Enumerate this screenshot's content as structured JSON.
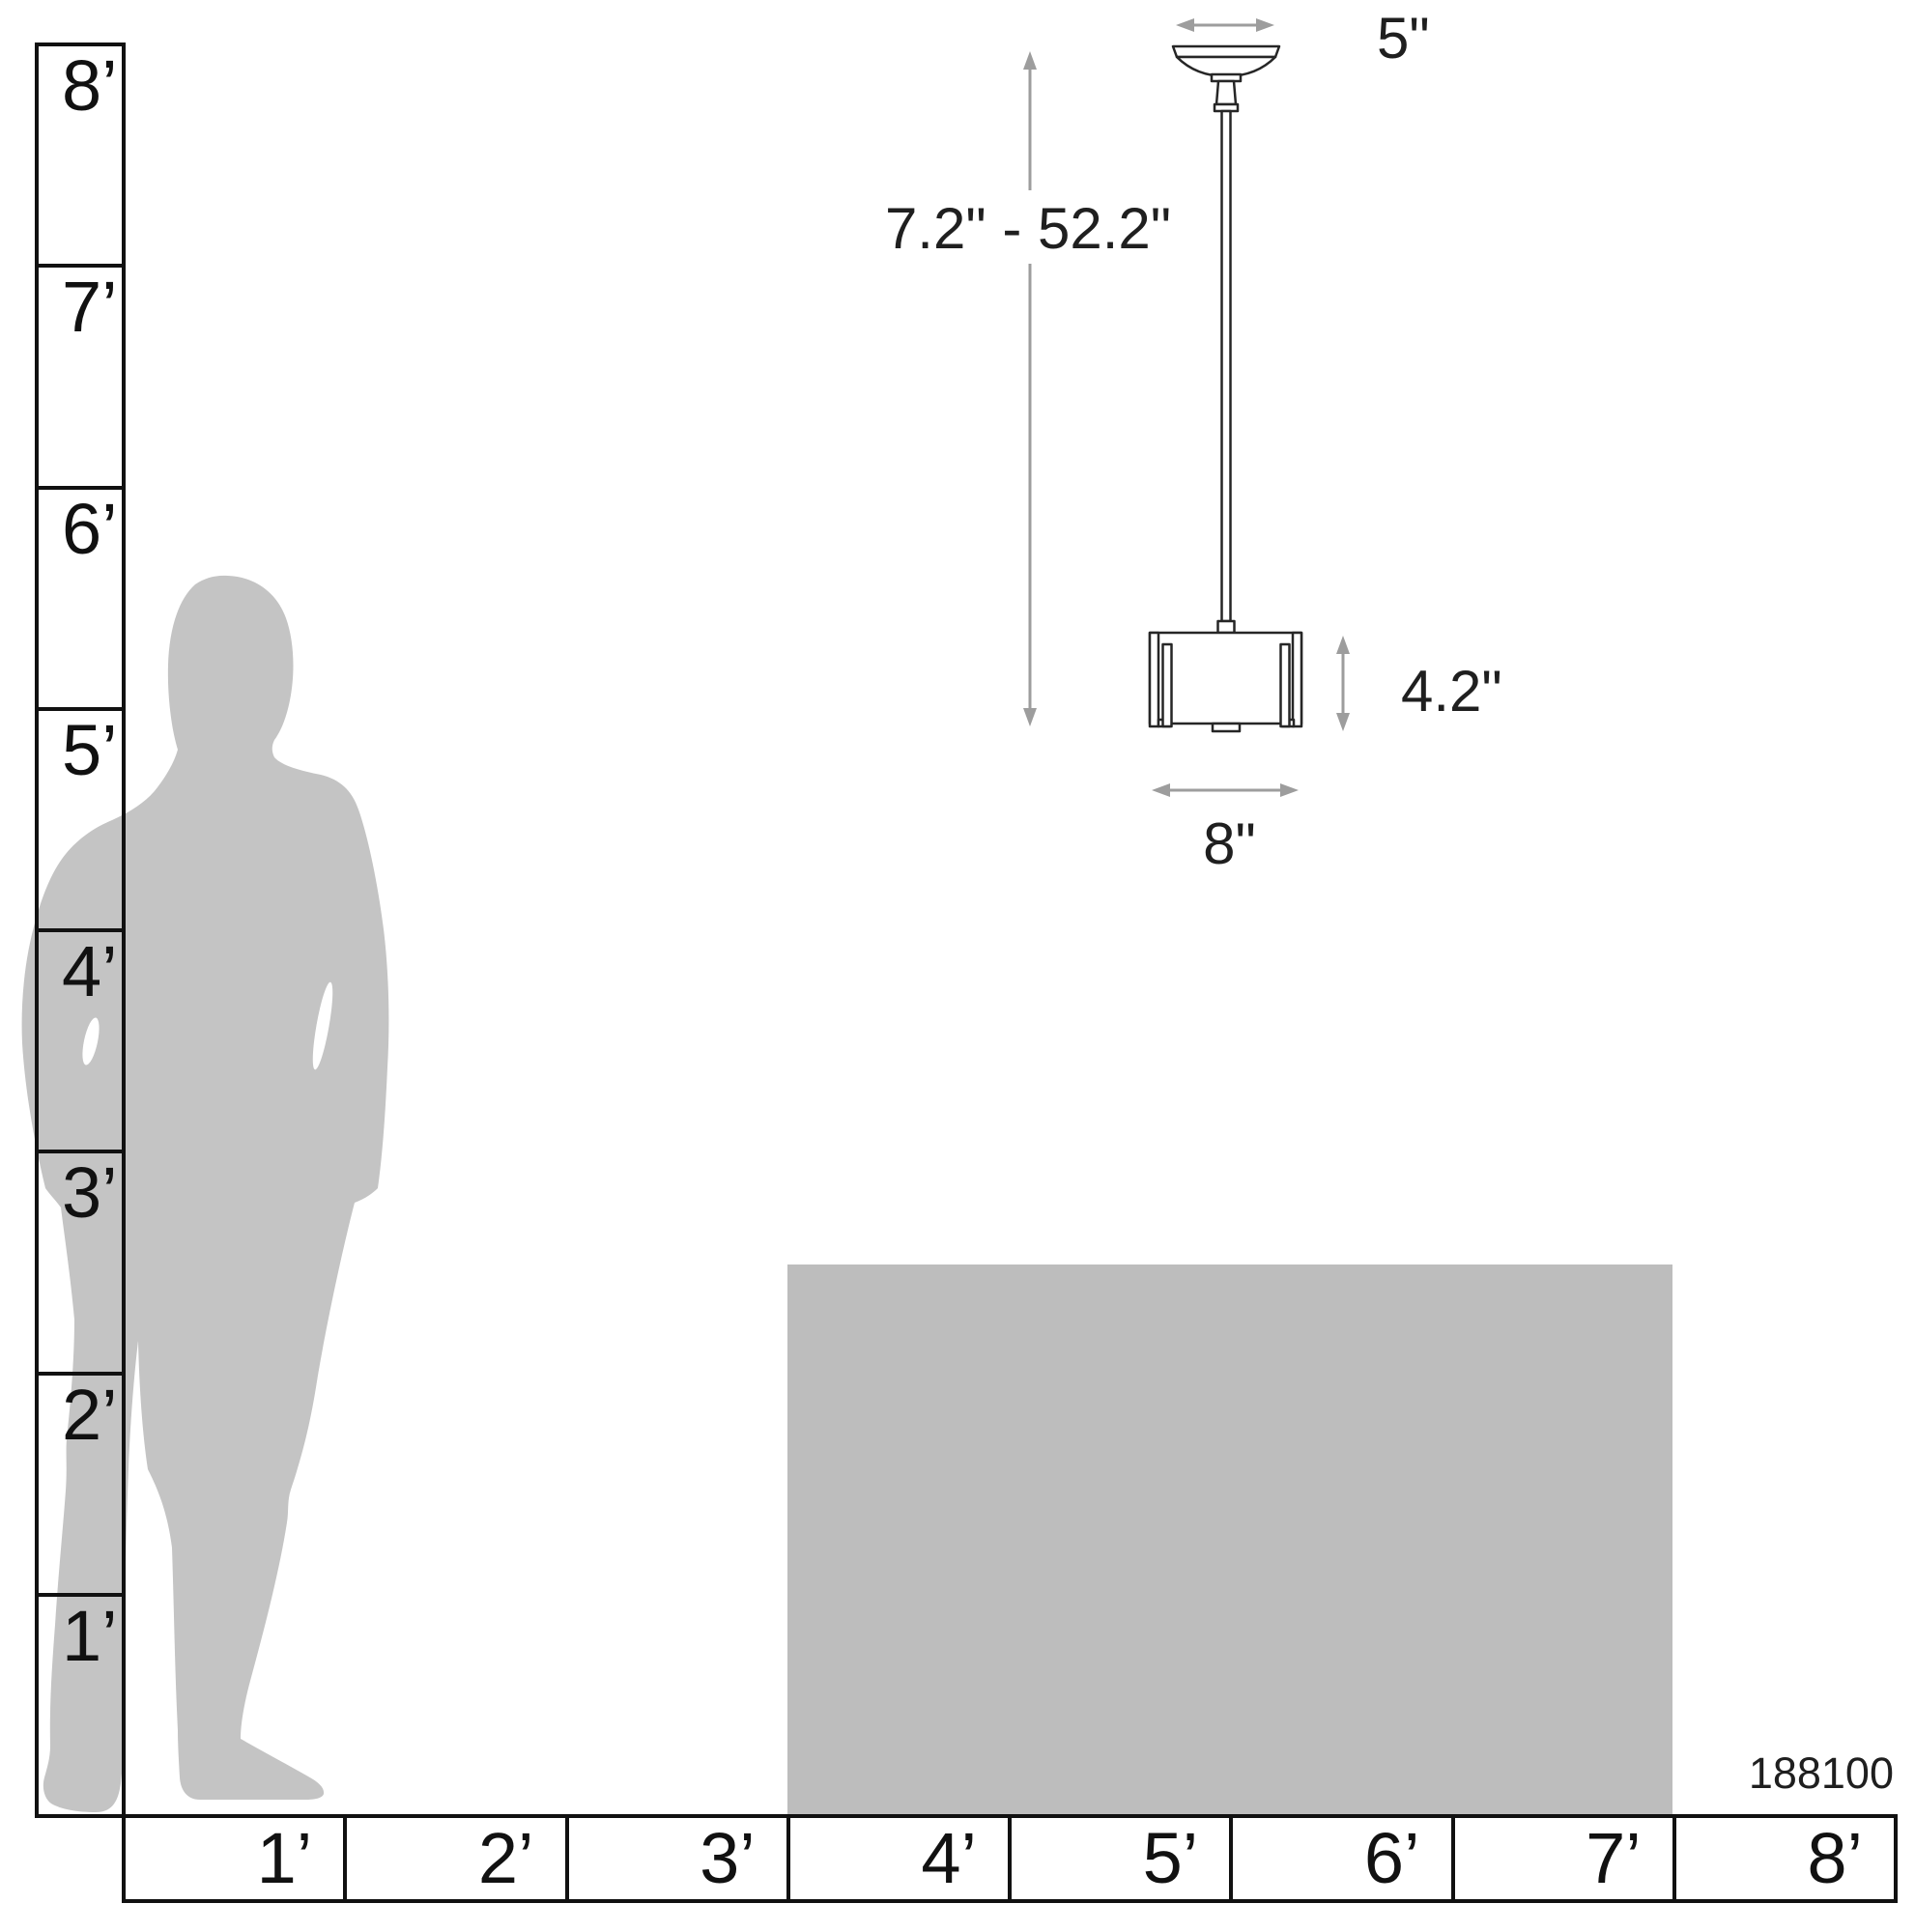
{
  "product": {
    "model_number": "188100"
  },
  "dimensions": {
    "canopy_width": "5\"",
    "height_range": "7.2\" - 52.2\"",
    "shade_height": "4.2\"",
    "shade_width": "8\""
  },
  "vertical_ruler": {
    "labels": [
      "8’",
      "7’",
      "6’",
      "5’",
      "4’",
      "3’",
      "2’",
      "1’"
    ]
  },
  "horizontal_ruler": {
    "labels": [
      "1’",
      "2’",
      "3’",
      "4’",
      "5’",
      "6’",
      "7’",
      "8’"
    ]
  },
  "colors": {
    "background": "#ffffff",
    "person_gray": "#c4c4c4",
    "table_gray": "#bdbdbd",
    "arrow_gray": "#9d9d9d",
    "line_black": "#111111",
    "text": "#1f1f1f"
  }
}
